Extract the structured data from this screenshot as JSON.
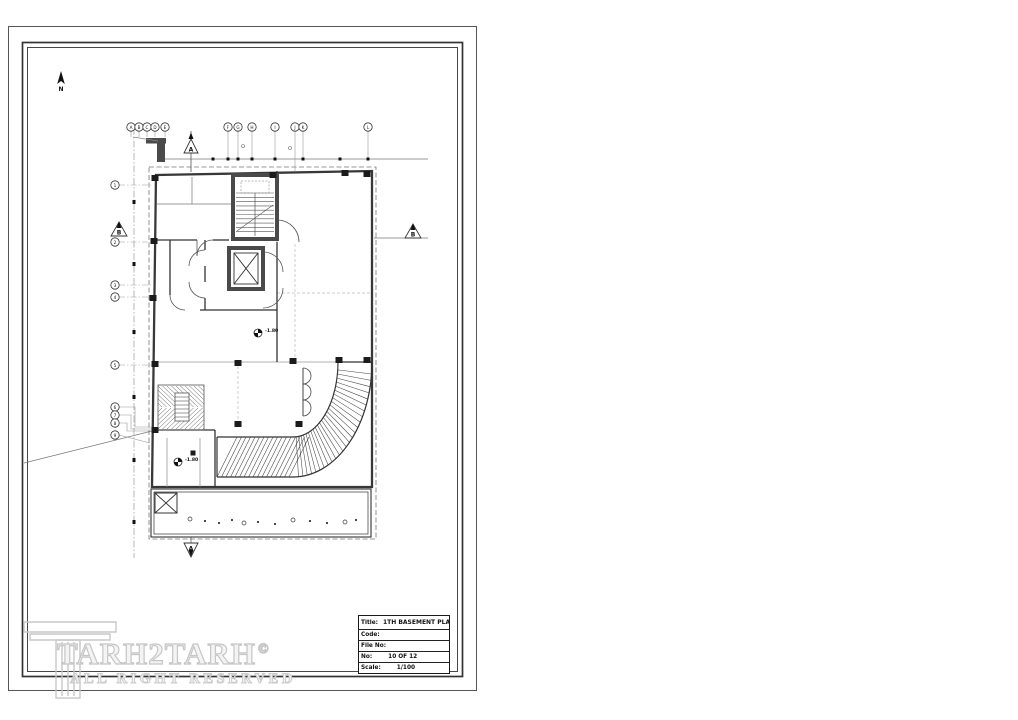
{
  "sheet": {
    "north_label": "N",
    "grid": {
      "top": [
        "A",
        "B",
        "C",
        "D",
        "E",
        "F",
        "G",
        "H",
        "I",
        "J",
        "K",
        "L"
      ],
      "left": [
        "1",
        "2",
        "3",
        "4",
        "5",
        "6",
        "7",
        "8",
        "9"
      ]
    },
    "section_markers": {
      "top": "A",
      "left": "B",
      "right": "B",
      "bottom": "A"
    },
    "level_markers": [
      "-1.80",
      "-1.80"
    ]
  },
  "title_block": {
    "rows": [
      {
        "label": "Title:",
        "value": "1TH BASEMENT PLAN"
      },
      {
        "label": "Code:",
        "value": ""
      },
      {
        "label": "File No:",
        "value": ""
      },
      {
        "label": "No:",
        "value": "10 OF 12"
      },
      {
        "label": "Scale:",
        "value": "1/100"
      }
    ]
  },
  "watermark": {
    "brand": "TARH2TARH",
    "copyright": "©",
    "tagline": "ALL RIGHT RESERVED"
  },
  "colors": {
    "line": "#333333",
    "wall": "#4a4a4a",
    "grid": "#999999",
    "watermark": "#c6c6c6"
  }
}
